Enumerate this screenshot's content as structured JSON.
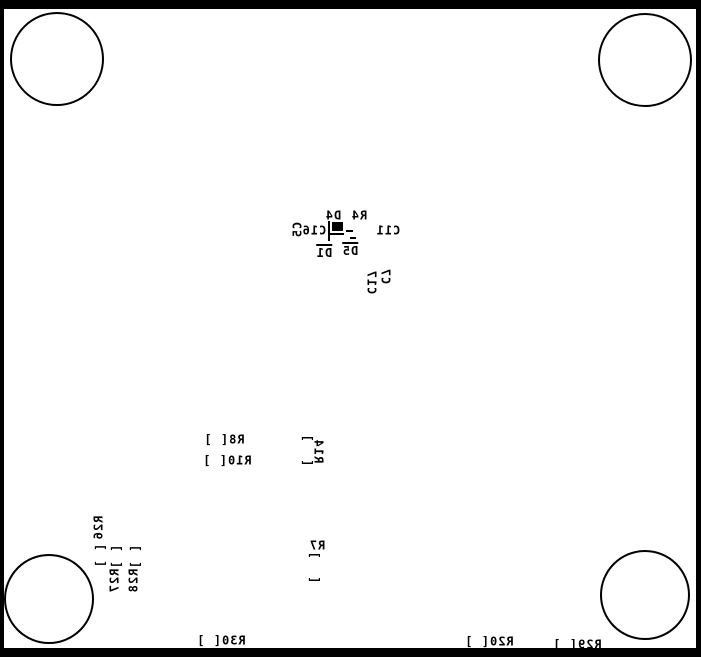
{
  "board": {
    "type": "pcb-silkscreen-bottom-view",
    "background": "#ffffff",
    "silkscreen_color": "#000000",
    "outline_color": "#000000",
    "mount_holes": [
      {
        "name": "top-left",
        "cx": 57,
        "cy": 59,
        "r": 47
      },
      {
        "name": "top-right",
        "cx": 645,
        "cy": 60,
        "r": 47
      },
      {
        "name": "bottom-left",
        "cx": 49,
        "cy": 599,
        "r": 45
      },
      {
        "name": "bottom-right",
        "cx": 645,
        "cy": 595,
        "r": 45
      }
    ],
    "components": [
      {
        "ref": "C5",
        "text": "C5",
        "x": 298,
        "y": 230,
        "dir": "v2"
      },
      {
        "ref": "C16",
        "text": "C16",
        "x": 314,
        "y": 231,
        "dir": "h"
      },
      {
        "ref": "D4",
        "text": "D4",
        "x": 333,
        "y": 216,
        "dir": "h"
      },
      {
        "ref": "R4",
        "text": "R4",
        "x": 359,
        "y": 216,
        "dir": "h"
      },
      {
        "ref": "D5",
        "text": "D5",
        "x": 350,
        "y": 250,
        "dir": "h",
        "overline": true
      },
      {
        "ref": "D1",
        "text": "D1",
        "x": 324,
        "y": 252,
        "dir": "h",
        "overline": true
      },
      {
        "ref": "C11",
        "text": "C11",
        "x": 388,
        "y": 231,
        "dir": "h"
      },
      {
        "ref": "C17",
        "text": "C17",
        "x": 371,
        "y": 282,
        "dir": "v1"
      },
      {
        "ref": "C7",
        "text": "C7",
        "x": 385,
        "y": 276,
        "dir": "v1"
      },
      {
        "ref": "R8",
        "text": "R8[ ]",
        "x": 224,
        "y": 440,
        "dir": "h"
      },
      {
        "ref": "R10",
        "text": "R10[ ]",
        "x": 227,
        "y": 461,
        "dir": "h"
      },
      {
        "ref": "R14",
        "text": "R14",
        "x": 318,
        "y": 451,
        "dir": "v1",
        "pads": {
          "x": 307,
          "y": 451,
          "wide": true
        }
      },
      {
        "ref": "R7",
        "text": "R7",
        "x": 317,
        "y": 546,
        "dir": "h",
        "pads": {
          "x": 314,
          "y": 568,
          "wide": true
        }
      },
      {
        "ref": "R26",
        "text": "R26",
        "x": 99,
        "y": 528,
        "dir": "v2",
        "pads": {
          "x": 100,
          "y": 556
        }
      },
      {
        "ref": "R27",
        "text": "R27",
        "x": 115,
        "y": 581,
        "dir": "v2",
        "pads": {
          "x": 116,
          "y": 557
        }
      },
      {
        "ref": "R28",
        "text": "R28",
        "x": 134,
        "y": 581,
        "dir": "v2",
        "pads": {
          "x": 135,
          "y": 557
        }
      },
      {
        "ref": "R30",
        "text": "R30[ ]",
        "x": 221,
        "y": 641,
        "dir": "h"
      },
      {
        "ref": "R20",
        "text": "R20[ ]",
        "x": 489,
        "y": 642,
        "dir": "h"
      },
      {
        "ref": "R29",
        "text": "R29[ ]",
        "x": 577,
        "y": 645,
        "dir": "h"
      }
    ],
    "footprint_marks": [
      {
        "name": "cap-outline-vline",
        "x": 328,
        "y": 221,
        "w": 2,
        "h": 20
      },
      {
        "name": "cap-body",
        "x": 332,
        "y": 222,
        "w": 11,
        "h": 9
      },
      {
        "name": "cap-outline-hline",
        "x": 328,
        "y": 233,
        "w": 16,
        "h": 2
      },
      {
        "name": "pad-dash-1",
        "x": 346,
        "y": 230,
        "w": 7,
        "h": 2
      },
      {
        "name": "pad-dash-2",
        "x": 350,
        "y": 237,
        "w": 6,
        "h": 2
      }
    ]
  }
}
